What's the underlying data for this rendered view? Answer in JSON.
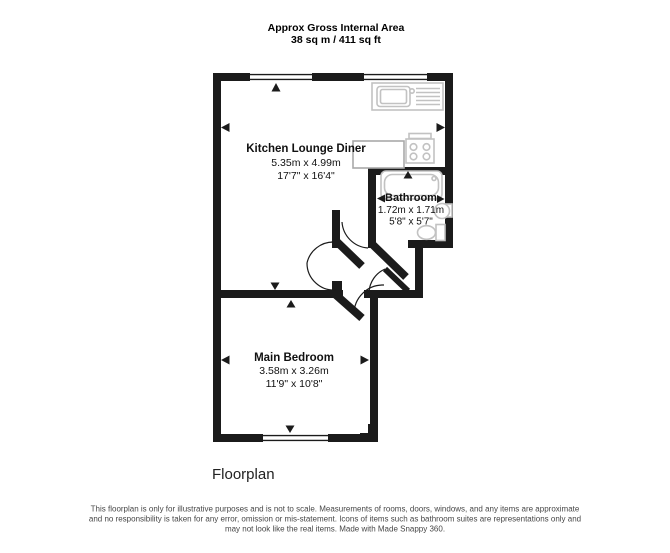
{
  "header": {
    "title": "Approx Gross Internal Area",
    "area": "38 sq m / 411 sq ft"
  },
  "rooms": [
    {
      "name": "Kitchen Lounge Diner",
      "metric": "5.35m x 4.99m",
      "imperial": "17'7\" x 16'4\""
    },
    {
      "name": "Bathroom",
      "metric": "1.72m x 1.71m",
      "imperial": "5'8\" x 5'7\""
    },
    {
      "name": "Main Bedroom",
      "metric": "3.58m x 3.26m",
      "imperial": "11'9\" x 10'8\""
    }
  ],
  "caption": "Floorplan",
  "disclaimer": [
    "This floorplan is only for illustrative purposes and is not to scale. Measurements of rooms, doors, windows, and any items are approximate",
    "and no responsibility is taken for any error, omission or mis-statement. Icons of items such as bathroom suites are representations only and",
    "may not look like the real items. Made with Made Snappy 360."
  ],
  "fixtures": [
    {
      "name": "kitchen-sink"
    },
    {
      "name": "hob"
    },
    {
      "name": "worktop"
    },
    {
      "name": "bathtub"
    },
    {
      "name": "basin"
    },
    {
      "name": "toilet"
    }
  ],
  "colors": {
    "wall": "#1b1b1b",
    "fixture": "#c2c2c2",
    "counter": "#a9a9a9",
    "label": "#111111",
    "disclaimer": "#474747"
  }
}
